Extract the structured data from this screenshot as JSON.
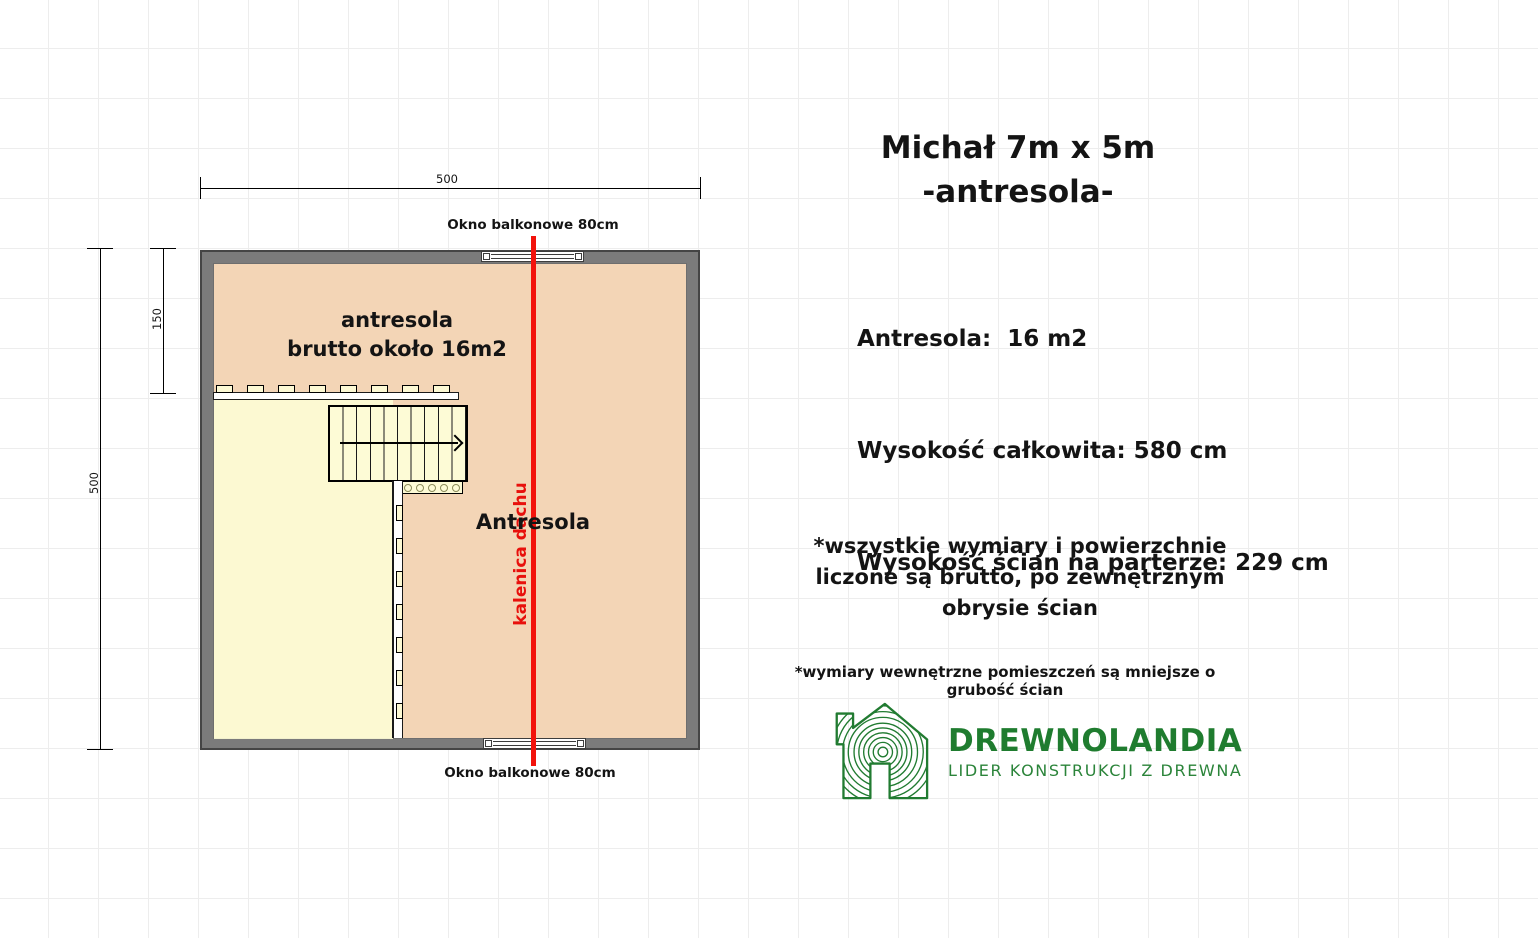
{
  "plan": {
    "dim_top": "500",
    "dim_left": "500",
    "dim_inner": "150",
    "window_top_label": "Okno balkonowe 80cm",
    "window_bottom_label": "Okno balkonowe 80cm",
    "mezzanine_line1": "antresola",
    "mezzanine_line2": "brutto około 16m2",
    "room_label": "Antresola",
    "ridge_label": "kalenica dachu",
    "colors": {
      "wall": "#7b7b7b",
      "floor": "#fbdbba",
      "void": "#fdfcd5",
      "ridge_red": "#f2130c"
    }
  },
  "info": {
    "title_line1": "Michał 7m x 5m",
    "title_line2": "-antresola-",
    "specs": [
      "Antresola:  16 m2",
      "Wysokość całkowita: 580 cm",
      "Wysokość ścian na parterze: 229 cm"
    ],
    "note_lines": [
      "*wszystkie wymiary i powierzchnie",
      "liczone są brutto, po zewnętrznym",
      "obrysie ścian"
    ],
    "footnote": "*wymiary wewnętrzne pomieszczeń są mniejsze o grubość ścian"
  },
  "logo": {
    "name": "DREWNOLANDIA",
    "tagline": "LIDER KONSTRUKCJI Z DREWNA",
    "green": "#1f7c2f"
  }
}
